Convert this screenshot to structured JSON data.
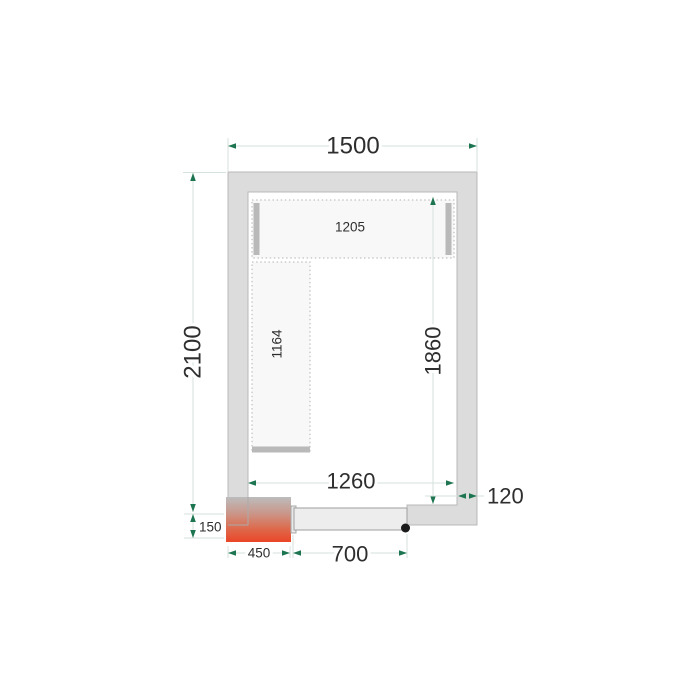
{
  "diagram": {
    "title": "cold-room-floor-plan",
    "dimensions": {
      "outer_width": "1500",
      "outer_depth": "2100",
      "inner_width": "1260",
      "inner_depth": "1860",
      "wall_thickness": "120",
      "door_width": "700",
      "door_frame_width": "450",
      "door_frame_height": "150",
      "top_shelf_length": "1205",
      "left_shelf_length": "1164"
    },
    "colors": {
      "wall_fill": "#dcdcdc",
      "wall_stroke": "#b8b8b8",
      "shelf_fill": "#f8f8f8",
      "shelf_dotted_border": "#b3b3b3",
      "shelf_end_bar": "#b9b9b9",
      "door_fill": "#ededed",
      "door_stroke": "#9e9e9e",
      "hinge_dot": "#1a1a1a",
      "dimension_line": "#d5e2db",
      "dimension_arrow": "#1c7450",
      "dimension_text": "#2e2e2e",
      "heater_gradient_top": "#bcbcbc",
      "heater_gradient_bottom": "#ea4527"
    }
  }
}
